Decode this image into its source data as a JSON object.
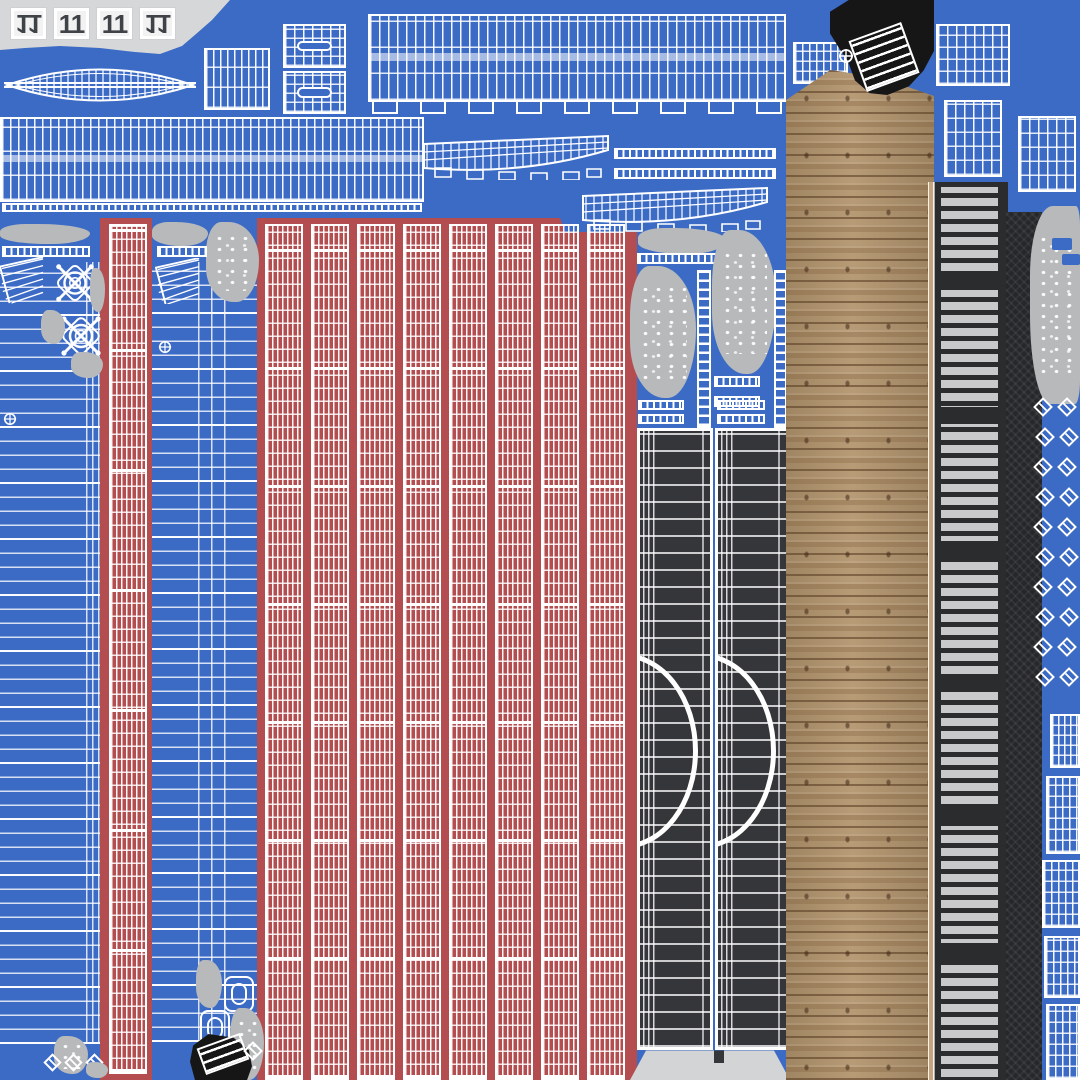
{
  "title": "Boat 3D-model UV texture atlas sheet",
  "palette": {
    "blue": "#3b6bc5",
    "red": "#b34d4f",
    "white": "#ffffff",
    "lightGray": "#d6d7d9",
    "gray": "#b7b9bb",
    "dark": "#35363a",
    "darker": "#26272a",
    "slat": "#c8c9ca",
    "black": "#161617",
    "wood": "#b2946d",
    "woodLight": "#c3a67f",
    "woodDark": "#6f5134",
    "tileBg": "#f2f2f3",
    "tileText": "#3f4246",
    "transom": "#d3d4d6"
  },
  "tiles": {
    "items": [
      {
        "label": "11",
        "flipped": true
      },
      {
        "label": "11",
        "flipped": false
      },
      {
        "label": "11",
        "flipped": false
      },
      {
        "label": "11",
        "flipped": true
      }
    ]
  },
  "regions": [
    {
      "name": "gray-top-left-patch",
      "type": "poly",
      "x": 0,
      "y": 0,
      "w": 232,
      "h": 56,
      "color": "lightGray",
      "clip": "polygon(0 0,230px 0,212px 20px,196px 34px,182px 46px,160px 54px,135px 52px,100px 48px,60px 46px,25px 48px,0 50px)"
    },
    {
      "name": "red-left-column",
      "type": "rect",
      "x": 100,
      "y": 218,
      "w": 52,
      "h": 862,
      "color": "red"
    },
    {
      "name": "red-main-block",
      "type": "poly",
      "x": 257,
      "y": 218,
      "w": 380,
      "h": 862,
      "color": "red",
      "clip": "polygon(0 0,303px 0,308px 14px,380px 14px,380px 100%,0 100%)"
    },
    {
      "name": "hull-bottom-lens",
      "type": "lens",
      "x": 4,
      "y": 52,
      "w": 192,
      "h": 66
    },
    {
      "name": "grid-island-a",
      "type": "wire",
      "x": 204,
      "y": 48,
      "w": 66,
      "h": 62,
      "vp": 7,
      "hp": 20
    },
    {
      "name": "grid-island-oval-top",
      "type": "wire",
      "x": 283,
      "y": 24,
      "w": 63,
      "h": 44,
      "vp": 9,
      "hp": 9,
      "oval": true
    },
    {
      "name": "grid-island-oval-bottom",
      "type": "wire",
      "x": 283,
      "y": 71,
      "w": 63,
      "h": 43,
      "vp": 9,
      "hp": 9,
      "oval": true
    },
    {
      "name": "top-wide-plank-band",
      "type": "wire",
      "x": 368,
      "y": 14,
      "w": 418,
      "h": 88,
      "vp": 9,
      "hp": 26,
      "band": true
    },
    {
      "name": "top-band-tabs",
      "type": "tabs",
      "x": 372,
      "y": 100,
      "w": 410,
      "h": 14,
      "count": 9
    },
    {
      "name": "grid-island-b",
      "type": "wire",
      "x": 793,
      "y": 42,
      "w": 55,
      "h": 42,
      "vp": 7,
      "hp": 10
    },
    {
      "name": "grid-island-c",
      "type": "wire",
      "x": 936,
      "y": 24,
      "w": 74,
      "h": 62,
      "vp": 9,
      "hp": 12
    },
    {
      "name": "grid-island-d",
      "type": "wire",
      "x": 944,
      "y": 100,
      "w": 58,
      "h": 77,
      "vp": 9,
      "hp": 14
    },
    {
      "name": "grid-island-e",
      "type": "wire",
      "x": 1018,
      "y": 116,
      "w": 58,
      "h": 76,
      "vp": 9,
      "hp": 14
    },
    {
      "name": "left-long-plank-band",
      "type": "wire",
      "x": 0,
      "y": 117,
      "w": 424,
      "h": 85,
      "vp": 8,
      "hp": 24,
      "band": true
    },
    {
      "name": "left-band-tick-strip",
      "type": "ruler",
      "x": 2,
      "y": 203,
      "w": 420,
      "h": 9
    },
    {
      "name": "hull-profile-a",
      "type": "profile",
      "x": 421,
      "y": 132,
      "w": 190,
      "h": 48
    },
    {
      "name": "thin-strip-a",
      "type": "ruler",
      "x": 614,
      "y": 148,
      "w": 162,
      "h": 11
    },
    {
      "name": "thin-strip-b",
      "type": "ruler",
      "x": 614,
      "y": 168,
      "w": 162,
      "h": 11
    },
    {
      "name": "hull-profile-b",
      "type": "profile",
      "x": 580,
      "y": 184,
      "w": 190,
      "h": 48
    },
    {
      "name": "red-left-grid",
      "type": "wire",
      "x": 109,
      "y": 224,
      "w": 38,
      "h": 850,
      "vp": 5,
      "hp": 13,
      "tk": 120
    },
    {
      "name": "red-stripe-col-1",
      "type": "wire",
      "x": 265,
      "y": 224,
      "w": 38,
      "h": 856,
      "vp": 5,
      "hp": 13,
      "tk": 118
    },
    {
      "name": "red-stripe-col-2",
      "type": "wire",
      "x": 311,
      "y": 224,
      "w": 38,
      "h": 856,
      "vp": 5,
      "hp": 13,
      "tk": 118
    },
    {
      "name": "red-stripe-col-3",
      "type": "wire",
      "x": 357,
      "y": 224,
      "w": 38,
      "h": 856,
      "vp": 5,
      "hp": 13,
      "tk": 118
    },
    {
      "name": "red-stripe-col-4",
      "type": "wire",
      "x": 403,
      "y": 224,
      "w": 38,
      "h": 856,
      "vp": 5,
      "hp": 13,
      "tk": 118
    },
    {
      "name": "red-stripe-col-5",
      "type": "wire",
      "x": 449,
      "y": 224,
      "w": 38,
      "h": 856,
      "vp": 5,
      "hp": 13,
      "tk": 118
    },
    {
      "name": "red-stripe-col-6",
      "type": "wire",
      "x": 495,
      "y": 224,
      "w": 38,
      "h": 856,
      "vp": 5,
      "hp": 13,
      "tk": 118
    },
    {
      "name": "red-stripe-col-7",
      "type": "wire",
      "x": 541,
      "y": 224,
      "w": 38,
      "h": 856,
      "vp": 5,
      "hp": 13,
      "tk": 118
    },
    {
      "name": "red-stripe-col-8",
      "type": "wire",
      "x": 587,
      "y": 224,
      "w": 38,
      "h": 856,
      "vp": 5,
      "hp": 13,
      "tk": 118
    },
    {
      "name": "hull-side-a-lines",
      "type": "hlines",
      "x": 0,
      "y": 260,
      "w": 100,
      "h": 784,
      "pitch": 14
    },
    {
      "name": "hull-side-a-edge",
      "type": "vlines",
      "x": 86,
      "y": 262,
      "w": 14,
      "h": 780,
      "pitch": 6
    },
    {
      "name": "hull-a-cloud-row",
      "type": "blob",
      "x": 0,
      "y": 224,
      "w": 90,
      "h": 20
    },
    {
      "name": "hull-a-ruler",
      "type": "ruler",
      "x": 2,
      "y": 246,
      "w": 88,
      "h": 11
    },
    {
      "name": "hull-a-fan",
      "type": "fan",
      "x": 0,
      "y": 256,
      "w": 44,
      "h": 48
    },
    {
      "name": "steering-wheel-1",
      "type": "wheel",
      "x": 52,
      "y": 260,
      "w": 46,
      "h": 46
    },
    {
      "name": "steering-wheel-2",
      "type": "wheel",
      "x": 57,
      "y": 312,
      "w": 48,
      "h": 48
    },
    {
      "name": "hull-a-blob-1",
      "type": "blob",
      "x": 90,
      "y": 268,
      "w": 15,
      "h": 44
    },
    {
      "name": "hull-a-blob-2",
      "type": "blob",
      "x": 41,
      "y": 310,
      "w": 24,
      "h": 34
    },
    {
      "name": "hull-a-blob-3",
      "type": "blob",
      "x": 71,
      "y": 352,
      "w": 32,
      "h": 26
    },
    {
      "name": "hull-a-ring",
      "type": "ring",
      "x": 3,
      "y": 412,
      "w": 14,
      "h": 14
    },
    {
      "name": "hull-a-bottom-blob",
      "type": "blob",
      "x": 54,
      "y": 1036,
      "w": 34,
      "h": 38,
      "speckle": true
    },
    {
      "name": "hull-a-bottom-diamonds",
      "type": "diamonds",
      "x": 46,
      "y": 1056,
      "w": 62,
      "h": 24,
      "rows": 1,
      "cols": 3,
      "px": 21,
      "py": 20,
      "size": 13
    },
    {
      "name": "hull-a-bottom-blob-2",
      "type": "blob",
      "x": 86,
      "y": 1062,
      "w": 22,
      "h": 16
    },
    {
      "name": "hull-side-b-lines",
      "type": "hlines",
      "x": 152,
      "y": 262,
      "w": 105,
      "h": 780,
      "pitch": 14
    },
    {
      "name": "hull-side-b-seam",
      "type": "vlines",
      "x": 198,
      "y": 262,
      "w": 38,
      "h": 780,
      "pitch": 13
    },
    {
      "name": "hull-b-cloud-row",
      "type": "blob",
      "x": 152,
      "y": 222,
      "w": 56,
      "h": 24
    },
    {
      "name": "hull-b-big-blob",
      "type": "blob",
      "x": 206,
      "y": 222,
      "w": 53,
      "h": 80,
      "speckle": true
    },
    {
      "name": "hull-b-ruler",
      "type": "ruler",
      "x": 157,
      "y": 246,
      "w": 50,
      "h": 11
    },
    {
      "name": "hull-b-fan",
      "type": "fan",
      "x": 155,
      "y": 258,
      "w": 46,
      "h": 46
    },
    {
      "name": "hull-b-ring",
      "type": "ring",
      "x": 158,
      "y": 340,
      "w": 14,
      "h": 14
    },
    {
      "name": "hull-b-bottom-blob-1",
      "type": "blob",
      "x": 196,
      "y": 960,
      "w": 26,
      "h": 48
    },
    {
      "name": "hatch-frame-1",
      "type": "sqframe",
      "x": 224,
      "y": 976,
      "w": 30,
      "h": 36
    },
    {
      "name": "hatch-frame-2",
      "type": "sqframe",
      "x": 200,
      "y": 1010,
      "w": 30,
      "h": 36
    },
    {
      "name": "hull-b-bottom-blob-2",
      "type": "blob",
      "x": 230,
      "y": 1008,
      "w": 34,
      "h": 72,
      "speckle": true
    },
    {
      "name": "black-guitar-blob",
      "type": "blackblob",
      "x": 190,
      "y": 1034,
      "w": 62,
      "h": 46,
      "clip": "polygon(30% 0,70% 8%,95% 35%,100% 70%,92% 100%,8% 100%,0 60%,5% 25%)"
    },
    {
      "name": "guitar-ladder",
      "type": "ladder",
      "x": 200,
      "y": 1040,
      "w": 46,
      "h": 28,
      "rot": -20
    },
    {
      "name": "hull-b-diamond",
      "type": "diamonds",
      "x": 246,
      "y": 1044,
      "w": 20,
      "h": 20,
      "rows": 1,
      "cols": 1,
      "px": 20,
      "py": 20,
      "size": 14
    },
    {
      "name": "mid-cloud-row",
      "type": "blob",
      "x": 638,
      "y": 228,
      "w": 88,
      "h": 26
    },
    {
      "name": "mid-ruler-top",
      "type": "ruler",
      "x": 637,
      "y": 253,
      "w": 88,
      "h": 11
    },
    {
      "name": "mid-speckle-blob-left",
      "type": "blob",
      "x": 630,
      "y": 266,
      "w": 66,
      "h": 132,
      "speckle": true
    },
    {
      "name": "mid-speckle-blob-right",
      "type": "blob",
      "x": 712,
      "y": 230,
      "w": 64,
      "h": 144,
      "speckle": true
    },
    {
      "name": "mid-ladder-left",
      "type": "ladder",
      "x": 697,
      "y": 270,
      "w": 14,
      "h": 158,
      "rot": 0
    },
    {
      "name": "mid-ladder-right",
      "type": "ladder",
      "x": 774,
      "y": 270,
      "w": 13,
      "h": 158,
      "rot": 0
    },
    {
      "name": "mid-ruler-a",
      "type": "ruler",
      "x": 714,
      "y": 376,
      "w": 46,
      "h": 11
    },
    {
      "name": "mid-ruler-b",
      "type": "ruler",
      "x": 714,
      "y": 396,
      "w": 46,
      "h": 11
    },
    {
      "name": "mid-ruler-c",
      "type": "ruler",
      "x": 638,
      "y": 400,
      "w": 46,
      "h": 10
    },
    {
      "name": "mid-ruler-d",
      "type": "ruler",
      "x": 638,
      "y": 414,
      "w": 46,
      "h": 10
    },
    {
      "name": "mid-ruler-e",
      "type": "ruler",
      "x": 717,
      "y": 400,
      "w": 48,
      "h": 10
    },
    {
      "name": "mid-ruler-f",
      "type": "ruler",
      "x": 717,
      "y": 414,
      "w": 48,
      "h": 10
    },
    {
      "name": "gray-fin-left",
      "type": "fin",
      "x": 656,
      "y": 436,
      "w": 56,
      "h": 34
    },
    {
      "name": "gray-fin-right",
      "type": "fin",
      "x": 736,
      "y": 436,
      "w": 54,
      "h": 34
    },
    {
      "name": "dark-deck-column-left",
      "type": "darkcol",
      "x": 637,
      "y": 428,
      "w": 76,
      "h": 622
    },
    {
      "name": "dark-deck-column-right",
      "type": "darkcol",
      "x": 715,
      "y": 428,
      "w": 74,
      "h": 622
    },
    {
      "name": "transom-shape",
      "type": "transom",
      "x": 630,
      "y": 1048,
      "w": 160,
      "h": 32,
      "clip": "polygon(0 100%,10% 8%,90% 8%,100% 100%)"
    },
    {
      "name": "wood-plank-column",
      "type": "wood",
      "x": 786,
      "y": 70,
      "w": 148,
      "h": 1010,
      "clip": "polygon(0 30px,30% 0,65% 8px,100% 26px,100% 100%,0 100%)"
    },
    {
      "name": "black-boot-blob",
      "type": "blackblob",
      "x": 830,
      "y": 0,
      "w": 104,
      "h": 98,
      "clip": "polygon(18% 0,100% 0,100% 52%,90% 72%,76% 88%,55% 97%,38% 95%,24% 82%,17% 62%,8% 48%,0 34%,0 12%)"
    },
    {
      "name": "boot-stairs-ladder",
      "type": "ladder",
      "x": 856,
      "y": 30,
      "w": 56,
      "h": 54,
      "rot": -20
    },
    {
      "name": "boot-ring",
      "type": "ring",
      "x": 838,
      "y": 48,
      "w": 16,
      "h": 16
    },
    {
      "name": "wood-edge-sliver",
      "type": "woodsliver",
      "x": 928,
      "y": 182,
      "w": 6,
      "h": 898
    },
    {
      "name": "dark-slat-column",
      "type": "slats",
      "x": 934,
      "y": 182,
      "w": 74,
      "h": 898
    },
    {
      "name": "dark-weave-column",
      "type": "weave",
      "x": 1006,
      "y": 212,
      "w": 36,
      "h": 868
    },
    {
      "name": "right-gray-blob",
      "type": "blob",
      "x": 1030,
      "y": 206,
      "w": 50,
      "h": 198,
      "speckle": true,
      "radius": "45% 8% 10% 40%/35% 10% 12% 45%"
    },
    {
      "name": "right-blue-chip-1",
      "type": "bluerect",
      "x": 1052,
      "y": 238,
      "w": 20,
      "h": 12
    },
    {
      "name": "right-blue-chip-2",
      "type": "bluerect",
      "x": 1062,
      "y": 254,
      "w": 18,
      "h": 11
    },
    {
      "name": "right-diamond-strip",
      "type": "diamonds",
      "x": 1036,
      "y": 400,
      "w": 46,
      "h": 304,
      "rows": 10,
      "cols": 2,
      "px": 24,
      "py": 30,
      "size": 14
    },
    {
      "name": "right-grid-stack-1",
      "type": "wire",
      "x": 1050,
      "y": 714,
      "w": 30,
      "h": 54,
      "vp": 6,
      "hp": 10
    },
    {
      "name": "right-grid-stack-2",
      "type": "wire",
      "x": 1046,
      "y": 776,
      "w": 34,
      "h": 78,
      "vp": 7,
      "hp": 11
    },
    {
      "name": "right-grid-stack-3",
      "type": "wire",
      "x": 1042,
      "y": 860,
      "w": 38,
      "h": 68,
      "vp": 7,
      "hp": 11
    },
    {
      "name": "right-grid-stack-4",
      "type": "wire",
      "x": 1044,
      "y": 936,
      "w": 36,
      "h": 62,
      "vp": 7,
      "hp": 11
    },
    {
      "name": "right-grid-stack-5",
      "type": "wire",
      "x": 1046,
      "y": 1004,
      "w": 34,
      "h": 76,
      "vp": 7,
      "hp": 11
    }
  ]
}
